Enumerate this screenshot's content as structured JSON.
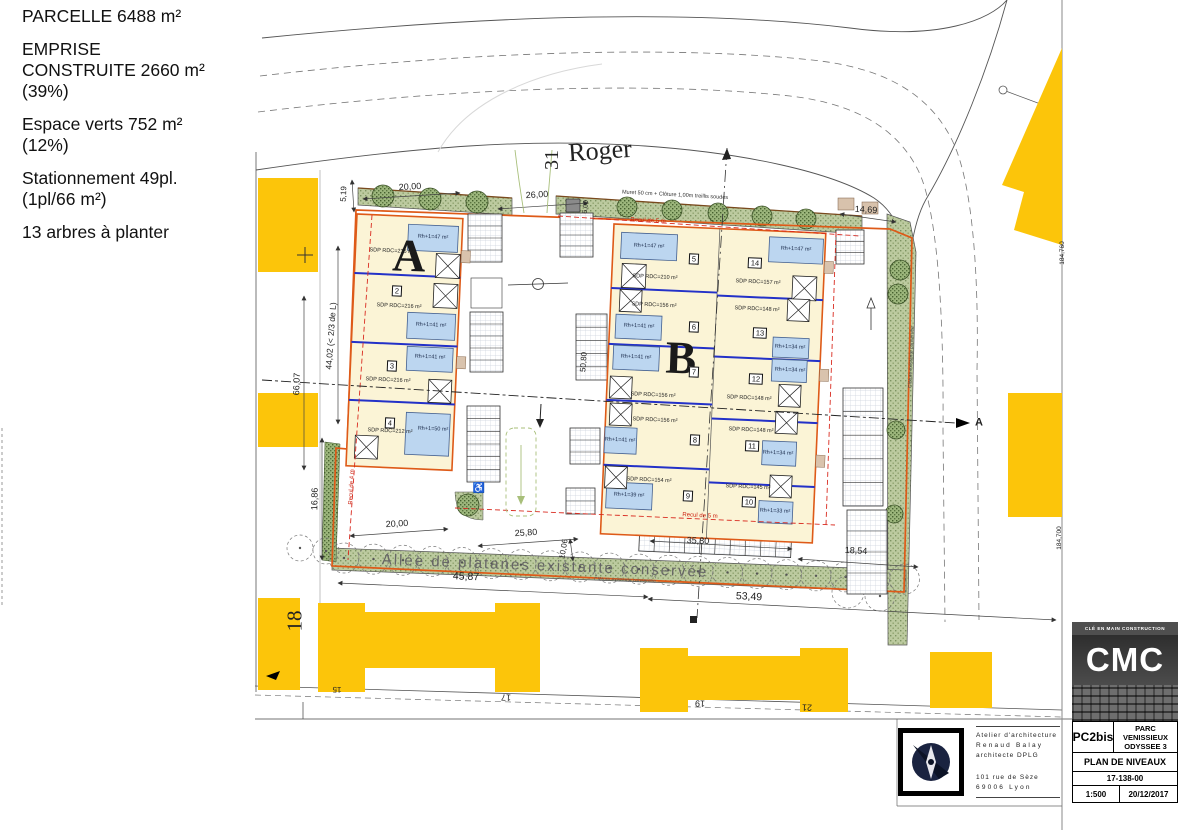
{
  "info_panel": {
    "paragraphs": [
      [
        "PARCELLE 6488 m²"
      ],
      [
        "EMPRISE",
        "CONSTRUITE 2660 m²",
        "(39%)"
      ],
      [
        "Espace verts 752 m²",
        "(12%)"
      ],
      [
        "Stationnement 49pl.",
        "(1pl/66 m²)"
      ],
      [
        "13 arbres à planter"
      ]
    ]
  },
  "streets": {
    "name": "Roger",
    "number_top": "31",
    "number_left": "18",
    "house_numbers": [
      "15",
      "17",
      "19",
      "21"
    ]
  },
  "dimensions": {
    "top_left": "20,00",
    "entrance": "26,00",
    "side_5_19": "5,19",
    "depth_6": "6,00",
    "right_14_69": "14,69",
    "left_66_07": "66,07",
    "left_44_02": "44,02 (< 2/3 de L)",
    "left_16_86": "16,86",
    "bottom_20_00": "20,00",
    "bottom_25_80": "25,80",
    "bottom_10_06": "10,06",
    "bottom_45_87": "45,87",
    "bottom_53_49": "53,49",
    "bottom_35_80": "35,80",
    "bottom_18_54": "18,54",
    "center_50_80": "50,80"
  },
  "levels": {
    "north": "184,760",
    "south": "184,700"
  },
  "notes": {
    "fence_top": "Muret 50 cm + Clôture 1,00m treillis soudés",
    "allee": "Allée de platanes existante conservée",
    "fence_right": "Clôture existante conservée",
    "fence_bottom": "Clôture existante conservée",
    "recul_top": "Recul de 5 m",
    "recul_bottom": "Recul de 5 m",
    "recul_left": "Recul de 4 m",
    "section_marker": "A"
  },
  "symbols": {
    "handicap": "♿"
  },
  "buildings": {
    "a": "A",
    "b": "B",
    "units": [
      {
        "no": "1",
        "sdp": "SDP RDC=216 m²",
        "rh": "Rh+1=47 m²"
      },
      {
        "no": "2",
        "sdp": "SDP RDC=216 m²",
        "rh": "Rh+1=41 m²"
      },
      {
        "no": "3",
        "sdp": "SDP RDC=216 m²",
        "rh": "Rh+1=41 m²"
      },
      {
        "no": "4",
        "sdp": "SDP RDC=212 m²",
        "rh": "Rh+1=50 m²"
      },
      {
        "no": "5",
        "sdp": "SDP RDC=210 m²",
        "rh": "Rh+1=47 m²"
      },
      {
        "no": "6",
        "sdp": "SDP RDC=156 m²",
        "rh": "Rh+1=41 m²"
      },
      {
        "no": "7",
        "sdp": "SDP RDC=156 m²",
        "rh": "Rh+1=41 m²"
      },
      {
        "no": "8",
        "sdp": "SDP RDC=156 m²",
        "rh": "Rh+1=41 m²"
      },
      {
        "no": "9",
        "sdp": "SDP RDC=154 m²",
        "rh": "Rh+1=39 m²"
      },
      {
        "no": "10",
        "sdp": "SDP RDC=145 m²",
        "rh": "Rh+1=33 m²"
      },
      {
        "no": "11",
        "sdp": "SDP RDC=148 m²",
        "rh": "Rh+1=34 m²"
      },
      {
        "no": "12",
        "sdp": "SDP RDC=148 m²",
        "rh": "Rh+1=34 m²"
      },
      {
        "no": "13",
        "sdp": "SDP RDC=148 m²",
        "rh": "Rh+1=34 m²"
      },
      {
        "no": "14",
        "sdp": "SDP RDC=157 m²",
        "rh": "Rh+1=47 m²"
      }
    ]
  },
  "architect": {
    "line1": "Atelier d'architecture",
    "line2": "Renaud Balay",
    "line3": "architecte DPLG",
    "line4": "101 rue de Sèze",
    "line5": "69006 Lyon"
  },
  "title_block": {
    "tagline": "CLÉ EN MAIN CONSTRUCTION",
    "logo": "CMC",
    "phase": "PC2bis",
    "project": "PARC VENISSIEUX ODYSSEE 3",
    "sheet": "PLAN DE NIVEAUX",
    "number": "17-138-00",
    "scale": "1:500",
    "date": "20/12/2017"
  },
  "colors": {
    "context_yellow": "#FCC50A",
    "building_cream": "#FBF4D6",
    "upper_floor_blue": "#BCD6F0",
    "divider_blue": "#2331C8",
    "boundary_orange": "#DE5A18",
    "setback_red": "#D92B20",
    "vegetation_green": "#9CB67C"
  }
}
